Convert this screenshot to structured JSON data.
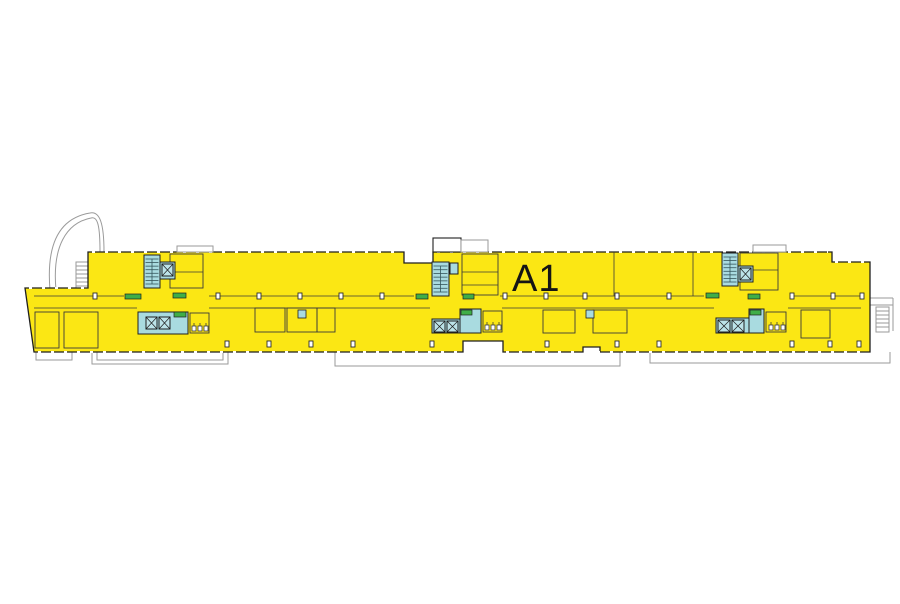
{
  "floor": {
    "label": "A1"
  },
  "colors": {
    "background": "#FFFFFF",
    "floor_fill": "#FBE714",
    "core_fill": "#A9DBE0",
    "lift_fill": "#BCE3E8",
    "accent_green": "#3FAE47",
    "outline": "#1F1F1F",
    "partition_line": "#3A3A3A",
    "exterior_line": "#9A9A9A",
    "stair_tread": "#35565C",
    "label_color": "#151515"
  },
  "columns": {
    "size": {
      "w": 4,
      "h": 6
    },
    "rows": [
      {
        "y": 293,
        "xs": [
          93,
          216,
          257,
          298,
          339,
          380,
          503,
          544,
          583,
          615,
          667,
          790,
          831,
          860
        ]
      },
      {
        "y": 341,
        "xs": [
          225,
          267,
          309,
          351,
          430,
          545,
          615,
          657,
          790,
          828,
          857
        ]
      }
    ]
  }
}
